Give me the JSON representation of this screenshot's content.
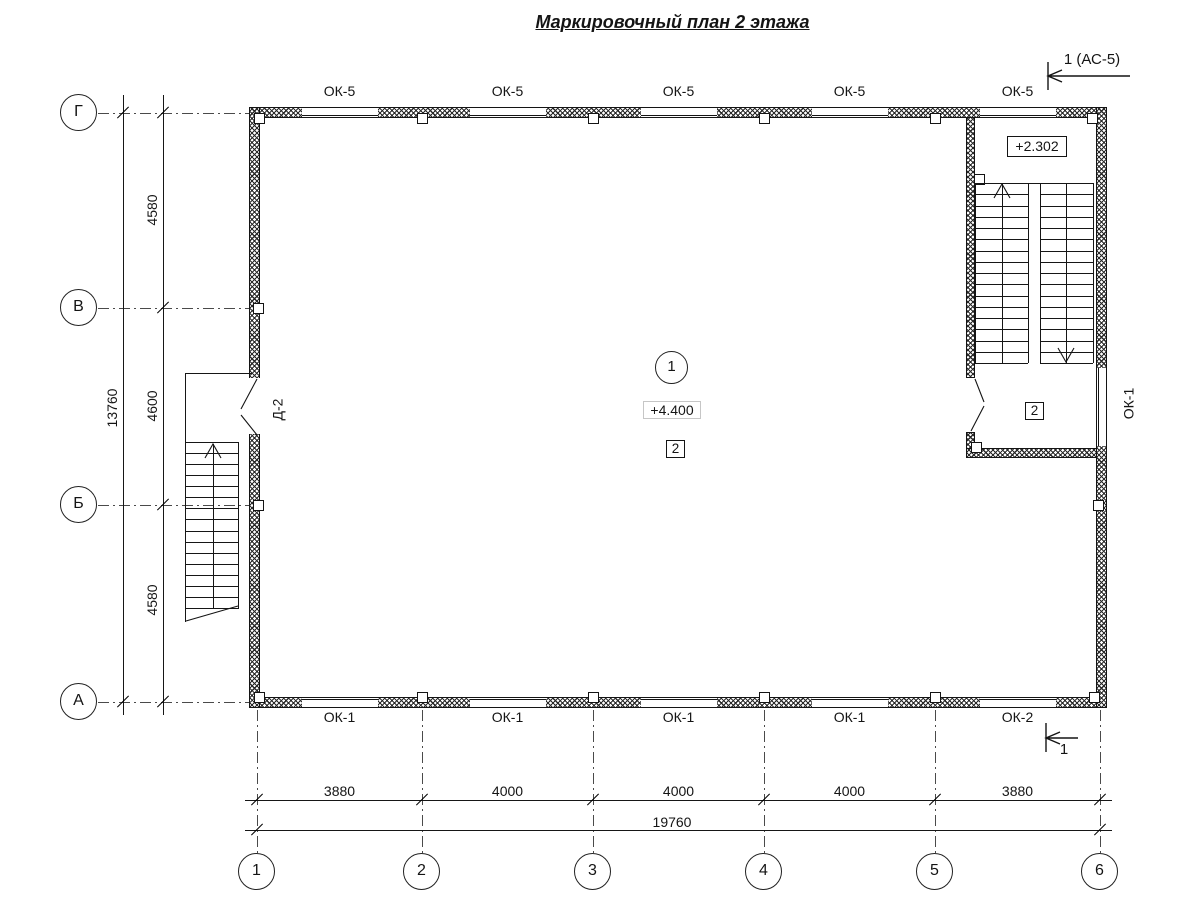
{
  "title": "Маркировочный план 2 этажа",
  "section_marks": {
    "top": "1 (АС-5)",
    "bottom": "1"
  },
  "room": {
    "number": "1",
    "elevation": "+4.400",
    "floor_mark": "2"
  },
  "stairwell": {
    "landing_elevation": "+2.302",
    "floor_mark": "2"
  },
  "doors": {
    "left_door_label": "Д-2"
  },
  "windows": {
    "top": [
      "ОК-5",
      "ОК-5",
      "ОК-5",
      "ОК-5",
      "ОК-5"
    ],
    "bottom": [
      "ОК-1",
      "ОК-1",
      "ОК-1",
      "ОК-1",
      "ОК-2"
    ],
    "right": "ОК-1"
  },
  "axes": {
    "horizontal": [
      "Г",
      "В",
      "Б",
      "А"
    ],
    "vertical": [
      "1",
      "2",
      "3",
      "4",
      "5",
      "6"
    ]
  },
  "dimensions": {
    "left_segments": [
      "4580",
      "4600",
      "4580"
    ],
    "left_total": "13760",
    "bottom_segments": [
      "3880",
      "4000",
      "4000",
      "4000",
      "3880"
    ],
    "bottom_total": "19760"
  },
  "colors": {
    "line": "#141414",
    "background": "#ffffff"
  }
}
